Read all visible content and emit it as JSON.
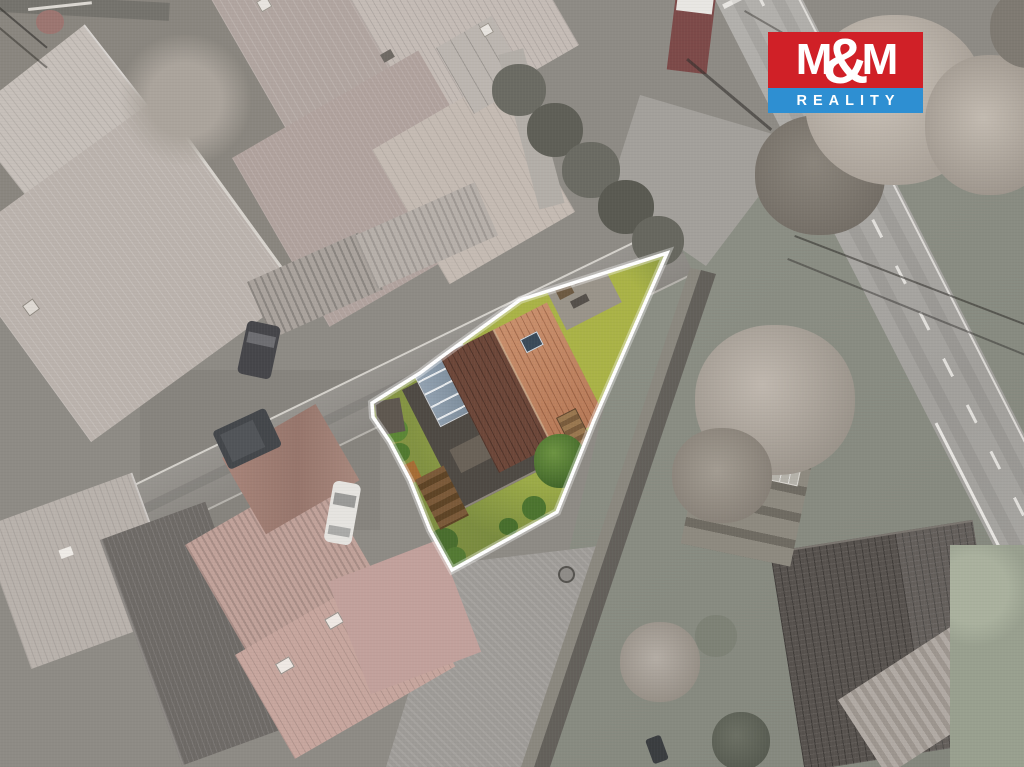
{
  "image": {
    "description": "Aerial drone photo of a village street block; surroundings desaturated to gray, one triangular building plot highlighted in full color and traced with a white boundary outline. A brown gabled-roof house with a glass conservatory and green garden sits inside the outlined plot. Roads, gray roofs, parked cars and trees surround it.",
    "highlight": {
      "outline_color": "#ffffff",
      "purpose": "property-boundary"
    }
  },
  "watermark": {
    "company": "M&M REALITY",
    "m_left": "M",
    "ampersand": "&",
    "m_right": "M",
    "subtitle": "REALITY",
    "red": "#d02027",
    "blue": "#2e8fd2",
    "text_color": "#ffffff"
  },
  "scene_colors": {
    "house_roof_dark_plane": "#6d4739",
    "house_roof_light_plane": "#c08261",
    "conservatory_glass": "#96a5b4",
    "parcel_grass": "#8d9b46",
    "main_road": "#aca9a5",
    "side_street": "#94918c",
    "gray_roofs": "#b5aca6",
    "road_markings": "#e9e7e3"
  }
}
